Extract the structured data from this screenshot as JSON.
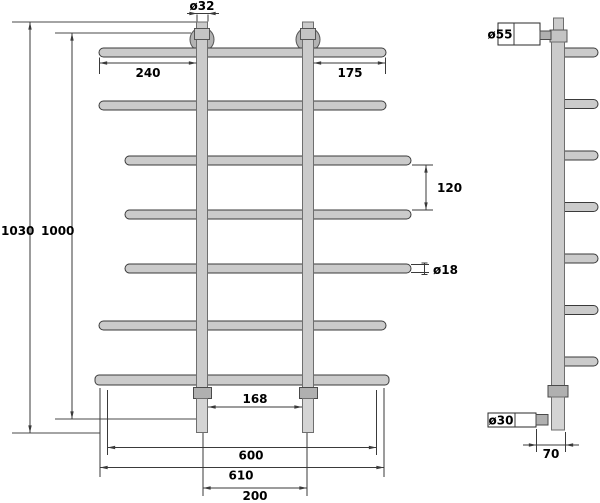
{
  "drawing": {
    "type": "technical-dimension-drawing",
    "subject": "ladder towel rail, front and side views"
  },
  "front_view": {
    "dims": {
      "post_diameter": "ø32",
      "left_offset": "240",
      "right_offset": "175",
      "total_height": "1030",
      "mount_height": "1000",
      "bar_gap": "120",
      "bar_diameter": "ø18",
      "inner_width": "168",
      "rail_width": "600",
      "bottom_bar_width": "610",
      "post_spacing": "200"
    }
  },
  "side_view": {
    "dims": {
      "bracket_diameter": "ø55",
      "connector_diameter": "ø30",
      "wall_distance": "70"
    }
  },
  "colors": {
    "bar_fill": "#cbcbcb",
    "line": "#3a3a3a",
    "text": "#000000",
    "background": "#ffffff"
  }
}
